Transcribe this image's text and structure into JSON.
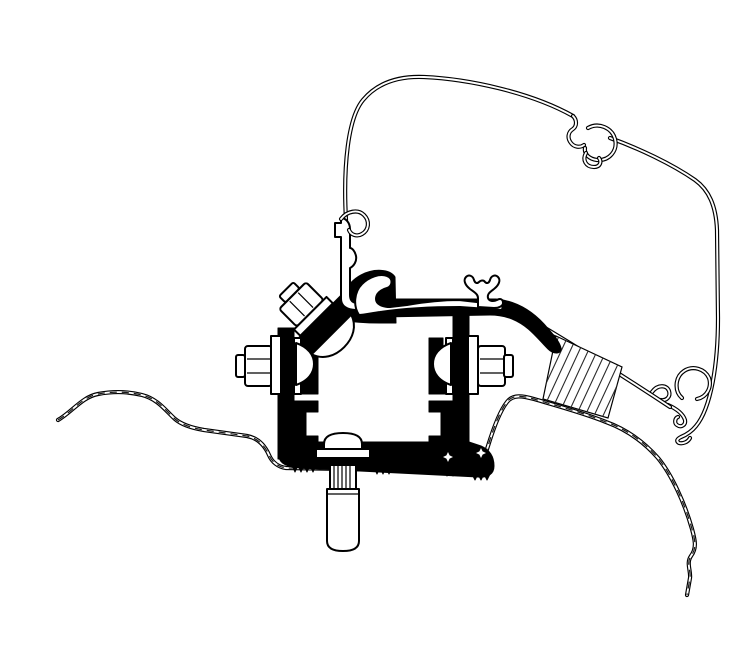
{
  "figure": {
    "description": "Technical cross-section line drawing of an awning mounting adapter bracket fixed to a van roof profile",
    "canvas": {
      "width": 732,
      "height": 615
    },
    "colors": {
      "background": "#ffffff",
      "line": "#000000",
      "fill_black": "#000000",
      "fill_white": "#ffffff"
    },
    "hatch": {
      "style": "diagonal",
      "angle_deg": 65,
      "spacing_px": 9
    },
    "components": [
      {
        "name": "awning-cover-profile",
        "label": "awning cover outline (large thin double-line arc)"
      },
      {
        "name": "cover-clip",
        "label": "C-shaped clip on top of cover arc"
      },
      {
        "name": "cover-end-hook",
        "label": "C-hook and lead-rail hooks at lower right of cover"
      },
      {
        "name": "mounting-rail-profile",
        "label": "white awning mounting rail profile with anchor lug"
      },
      {
        "name": "rail-anchor-lug",
        "label": "double-Y anchor lug on rail"
      },
      {
        "name": "vertical-channel-profile",
        "label": "vertical channel profile with top curl hook"
      },
      {
        "name": "adapter-bracket",
        "label": "black adapter bracket frame (solid cross-section)"
      },
      {
        "name": "left-bolt",
        "label": "left horizontal hex bolt with washers"
      },
      {
        "name": "right-bolt",
        "label": "right horizontal hex bolt with washers"
      },
      {
        "name": "angled-bolt",
        "label": "45-degree hex bolt at top left with curved washer"
      },
      {
        "name": "base-bolt",
        "label": "bottom dome-head bolt with threaded shaft and sleeve nut"
      },
      {
        "name": "roof-sheet",
        "label": "van roof sheet metal (dashed double line, left)"
      },
      {
        "name": "body-edge",
        "label": "van body edge curve (dashed double line, right)"
      },
      {
        "name": "sealing-block",
        "label": "hatched sealing/spacer block"
      },
      {
        "name": "serrated-base",
        "label": "serrated clamping teeth under bracket base"
      }
    ]
  }
}
